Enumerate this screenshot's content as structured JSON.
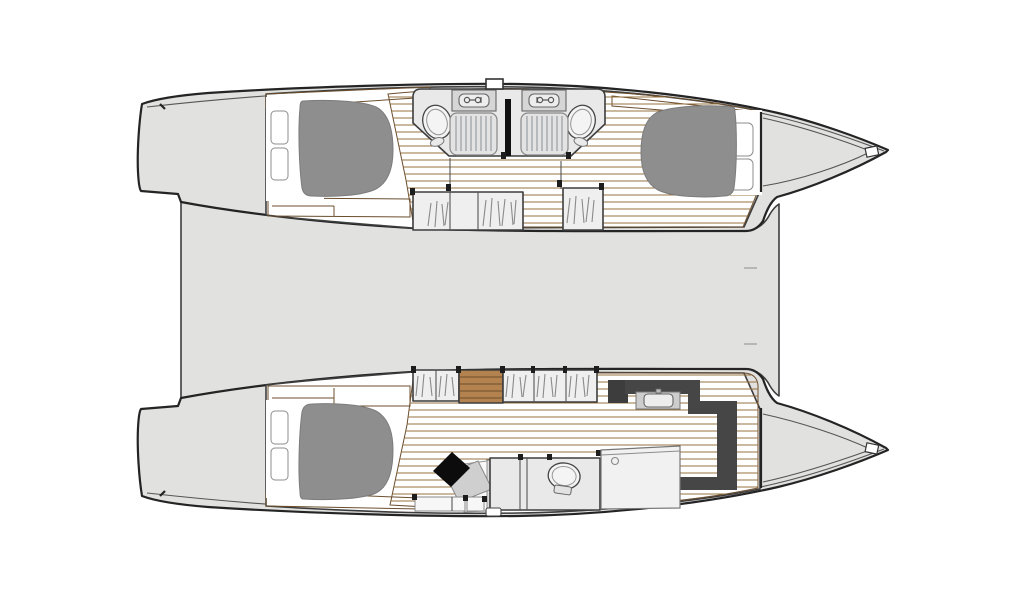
{
  "meta": {
    "diagram_type": "catamaran-deck-plan",
    "view": "top-down",
    "text_labels": []
  },
  "colors": {
    "background": "#ffffff",
    "hull": "#e1e1e0",
    "interior": "#ffffff",
    "wood": "#b3824e",
    "plank": "#96703f",
    "mattress": "#8e8e8e",
    "bedding": "#ffffff",
    "room": "#e9e9e9",
    "fixture": "#d6d6d6",
    "basin": "#ededed",
    "grating": "#9aa0a3",
    "wardrobe": "#efefef",
    "hatchmark": "#8a8a8a",
    "dark_wall": "#464646",
    "chair": "#0c0c0c",
    "desk": "#cfcfcf",
    "panel": "#f1f1f1"
  },
  "features": {
    "center_deck": [
      "saloon-deck",
      "forward-beam-deck",
      "stern-platforms"
    ],
    "top_hull": [
      "aft-double-berth",
      "aft-head-with-shower",
      "forward-head-with-shower",
      "forward-double-berth",
      "wardrobes",
      "companionway",
      "deck-hatch",
      "bow-locker",
      "anchor-roller"
    ],
    "bottom_hull": [
      "aft-double-berth",
      "wardrobes",
      "companionway-stairs",
      "desk-with-chair",
      "head-compartment",
      "shower-compartment",
      "vanity-sink",
      "bow-locker",
      "anchor-roller",
      "boarding-step"
    ]
  }
}
